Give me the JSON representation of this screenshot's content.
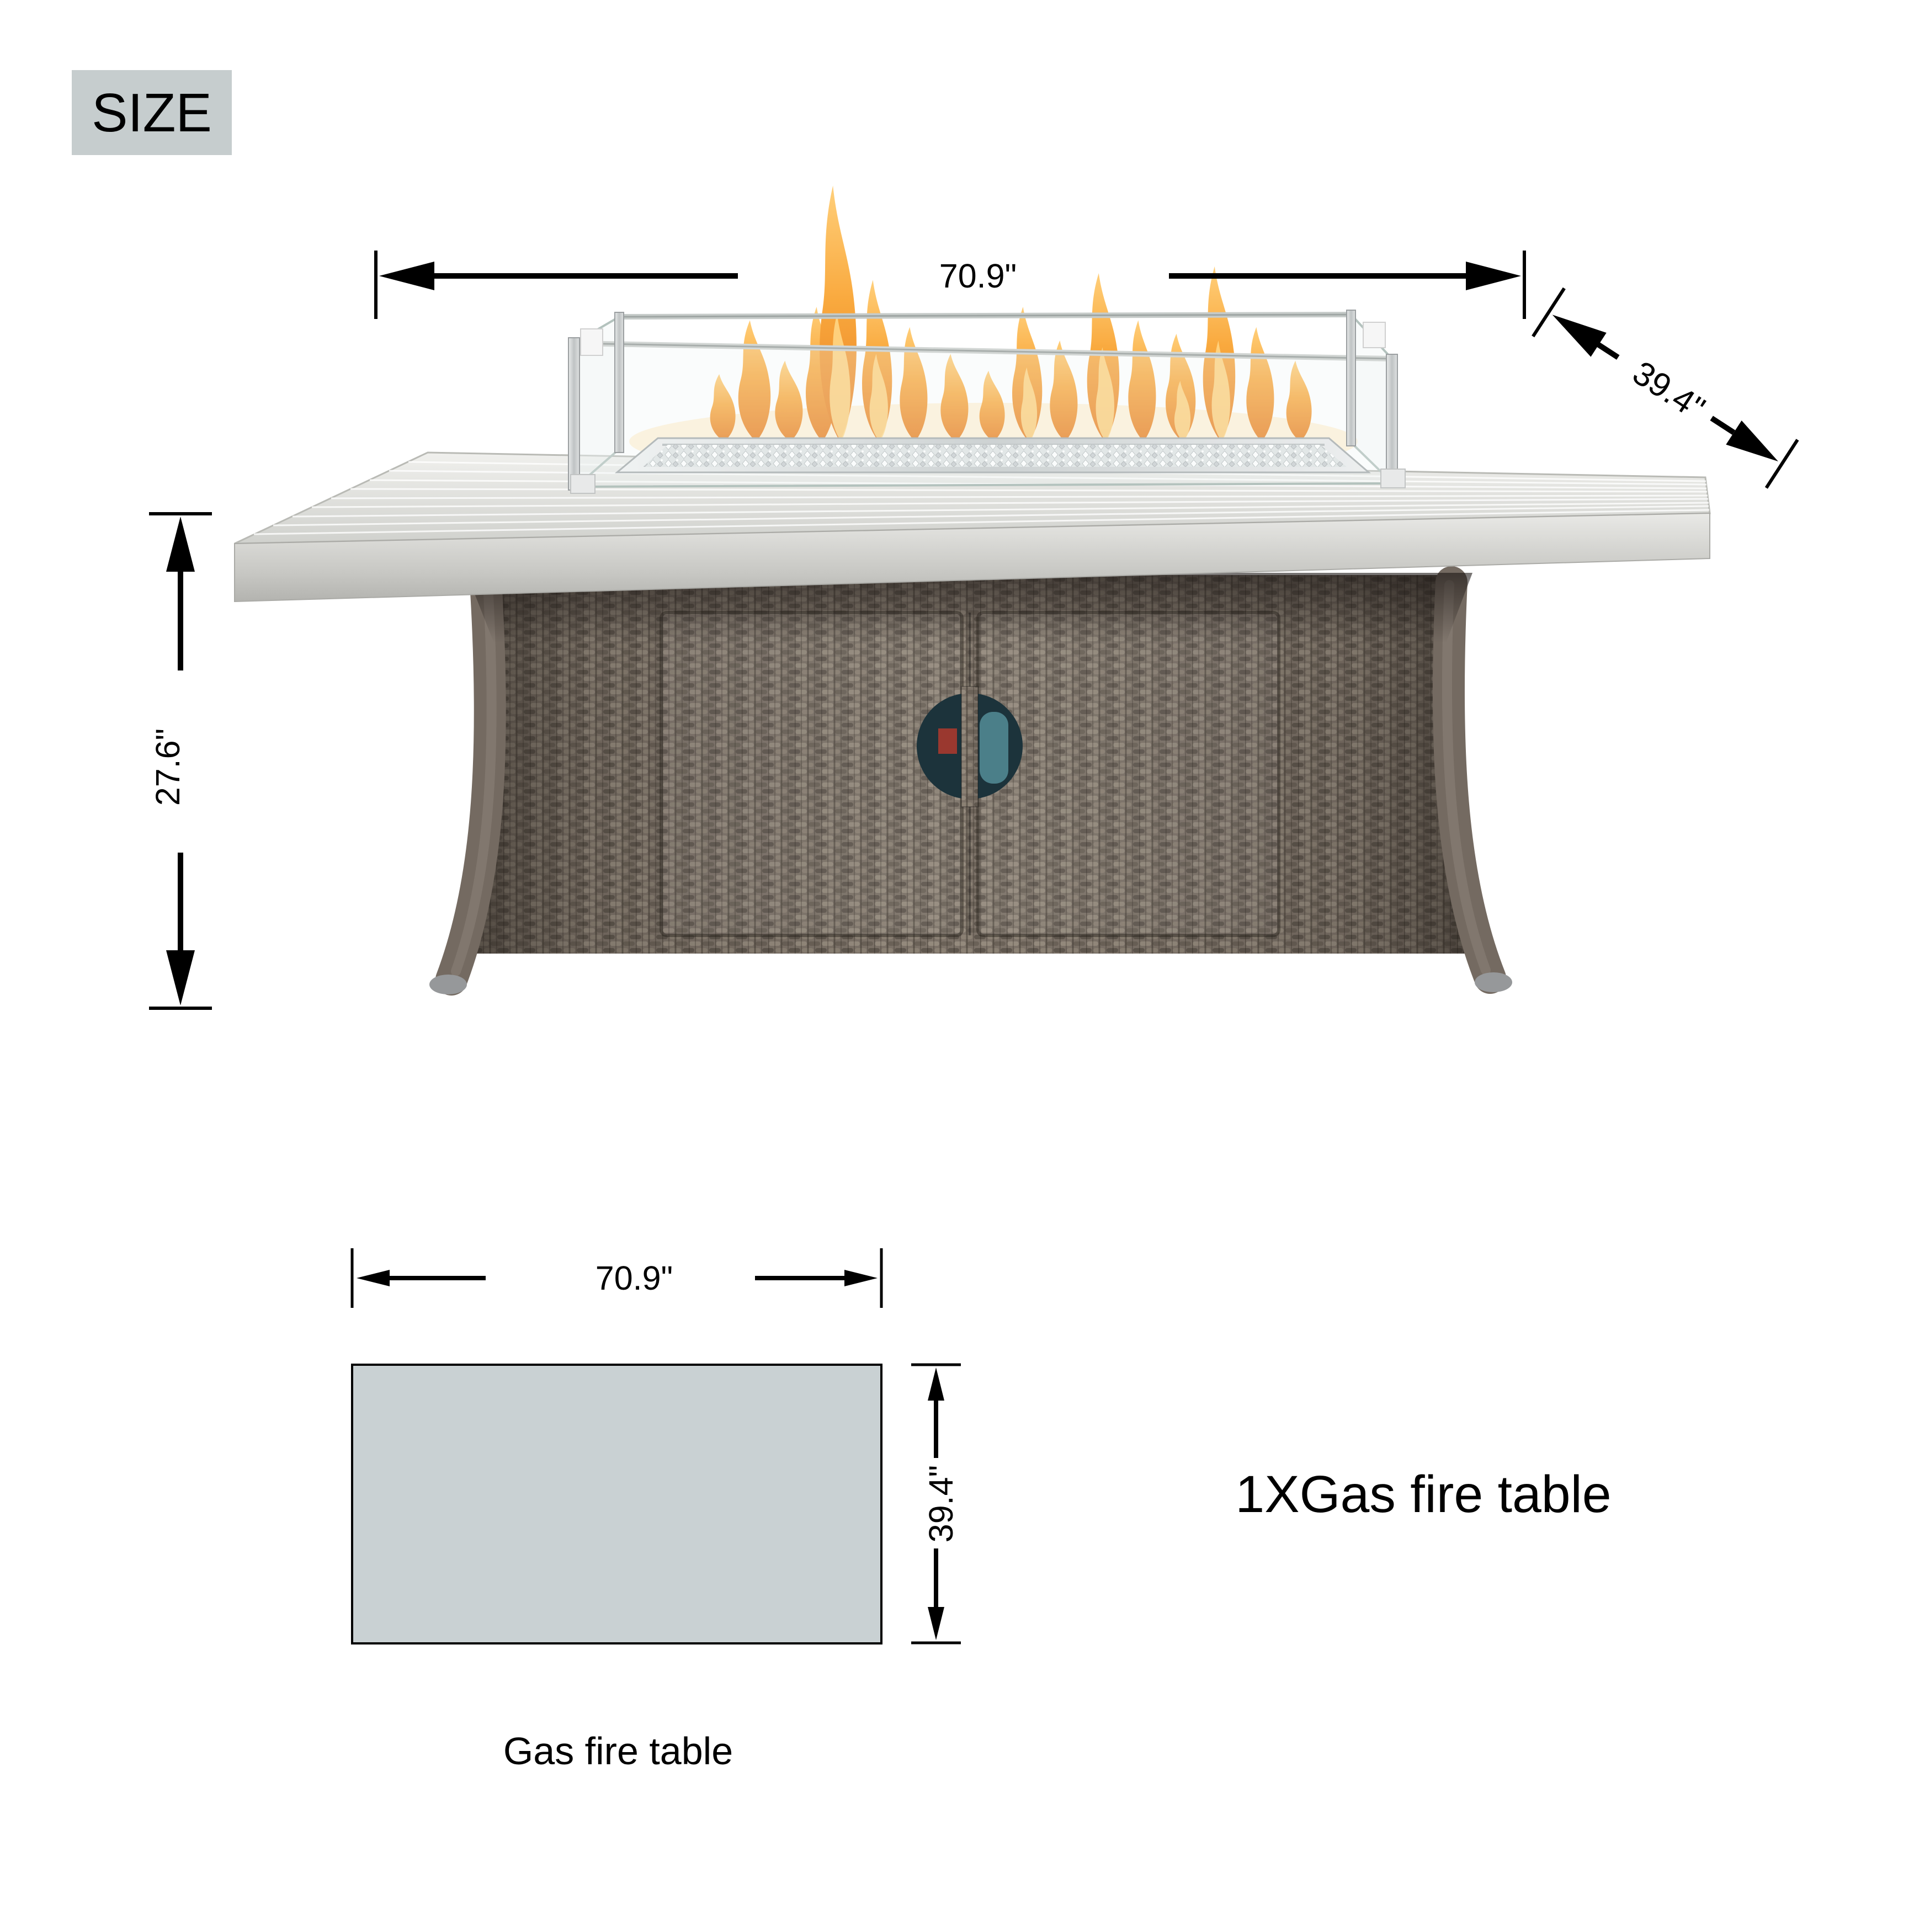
{
  "page": {
    "background": "#ffffff",
    "title": "Gas fire table size diagram"
  },
  "size_badge": {
    "label": "SIZE",
    "background": "#c6cdce",
    "text_color": "#000000"
  },
  "product_view": {
    "width_label": "70.9\"",
    "depth_label": "39.4\"",
    "height_label": "27.6\""
  },
  "top_view": {
    "width_label": "70.9\"",
    "depth_label": "39.4\"",
    "caption": "Gas fire table",
    "fill": "#c9d1d3"
  },
  "includes": {
    "label": "1XGas fire table"
  },
  "colors": {
    "dimension_lines": "#000000",
    "flame_orange": "#f09a3e",
    "flame_light": "#ffd685",
    "wicker_brown": "#7c7268",
    "tabletop_gray": "#d9dad6",
    "diagram_fill": "#c9d1d3"
  }
}
